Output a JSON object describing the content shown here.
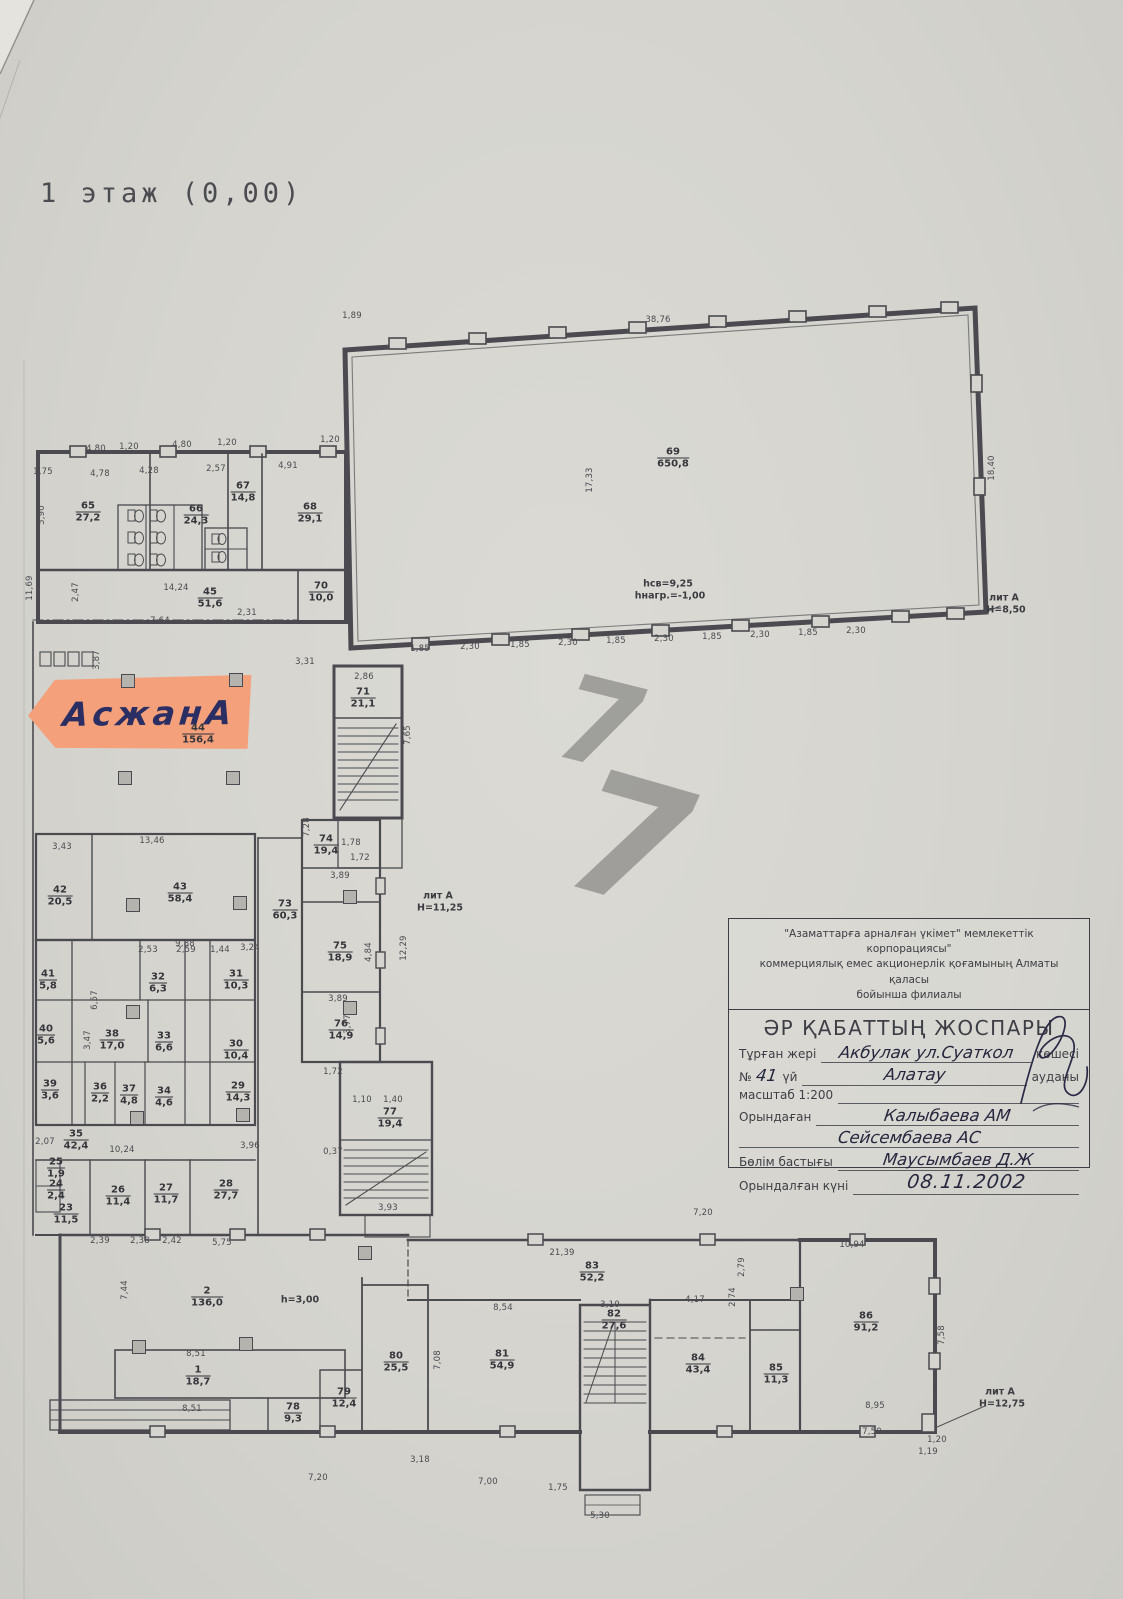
{
  "page": {
    "floor_title": "1 этаж (0,00)"
  },
  "sticker": {
    "text": "АсжанА"
  },
  "watermark": [
    {
      "t": "7",
      "x": 600,
      "y": 724,
      "s": 118,
      "r": 14
    },
    {
      "t": "7",
      "x": 630,
      "y": 842,
      "s": 168,
      "r": 16
    }
  ],
  "title_block": {
    "org_line1": "\"Азаматтарға арналған үкімет\" мемлекеттік корпорациясы\"",
    "org_line2": "коммерциялық емес акционерлік қоғамының Алматы қаласы",
    "org_line3": "бойынша филиалы",
    "heading": "ӘР ҚАБАТТЫҢ ЖОСПАРЫ",
    "label_location": "Тұрған жері",
    "location_value": "Акбулак ул.Суаткол",
    "label_street_suffix": "көшесі",
    "label_no": "№",
    "house_no": "41",
    "label_house": "үй",
    "district_value": "Алатау",
    "label_district": "ауданы",
    "scale": "масштаб 1:200",
    "label_executor": "Орындаған",
    "executor1": "Калыбаева АМ",
    "executor2": "Сейсембаева АС",
    "label_head": "Бөлім бастығы",
    "head_name": "Маусымбаев Д.Ж",
    "label_date": "Орындалған күні",
    "date": "08.11.2002"
  },
  "plan": {
    "rooms": [
      {
        "n": "65",
        "a": "27,2",
        "x": 88,
        "y": 512
      },
      {
        "n": "66",
        "a": "24,3",
        "x": 196,
        "y": 515
      },
      {
        "n": "67",
        "a": "14,8",
        "x": 243,
        "y": 492
      },
      {
        "n": "68",
        "a": "29,1",
        "x": 310,
        "y": 513
      },
      {
        "n": "45",
        "a": "51,6",
        "x": 210,
        "y": 598
      },
      {
        "n": "70",
        "a": "10,0",
        "x": 321,
        "y": 592
      },
      {
        "n": "71",
        "a": "21,1",
        "x": 363,
        "y": 698
      },
      {
        "n": "44",
        "a": "156,4",
        "x": 198,
        "y": 734
      },
      {
        "n": "74",
        "a": "19,4",
        "x": 326,
        "y": 845
      },
      {
        "n": "73",
        "a": "60,3",
        "x": 285,
        "y": 910
      },
      {
        "n": "75",
        "a": "18,9",
        "x": 340,
        "y": 952
      },
      {
        "n": "76",
        "a": "14,9",
        "x": 341,
        "y": 1030
      },
      {
        "n": "77",
        "a": "19,4",
        "x": 390,
        "y": 1118
      },
      {
        "n": "69",
        "a": "650,8",
        "x": 673,
        "y": 458
      },
      {
        "n": "42",
        "a": "20,5",
        "x": 60,
        "y": 896
      },
      {
        "n": "43",
        "a": "58,4",
        "x": 180,
        "y": 893
      },
      {
        "n": "41",
        "a": "5,8",
        "x": 48,
        "y": 980
      },
      {
        "n": "32",
        "a": "6,3",
        "x": 158,
        "y": 983
      },
      {
        "n": "31",
        "a": "10,3",
        "x": 236,
        "y": 980
      },
      {
        "n": "40",
        "a": "5,6",
        "x": 46,
        "y": 1035
      },
      {
        "n": "38",
        "a": "17,0",
        "x": 112,
        "y": 1040
      },
      {
        "n": "33",
        "a": "6,6",
        "x": 164,
        "y": 1042
      },
      {
        "n": "30",
        "a": "10,4",
        "x": 236,
        "y": 1050
      },
      {
        "n": "39",
        "a": "3,6",
        "x": 50,
        "y": 1090
      },
      {
        "n": "36",
        "a": "2,2",
        "x": 100,
        "y": 1093
      },
      {
        "n": "37",
        "a": "4,8",
        "x": 129,
        "y": 1095
      },
      {
        "n": "34",
        "a": "4,6",
        "x": 164,
        "y": 1097
      },
      {
        "n": "29",
        "a": "14,3",
        "x": 238,
        "y": 1092
      },
      {
        "n": "35",
        "a": "42,4",
        "x": 76,
        "y": 1140
      },
      {
        "n": "25",
        "a": "1,9",
        "x": 56,
        "y": 1168
      },
      {
        "n": "24",
        "a": "2,4",
        "x": 56,
        "y": 1190
      },
      {
        "n": "23",
        "a": "11,5",
        "x": 66,
        "y": 1214
      },
      {
        "n": "26",
        "a": "11,4",
        "x": 118,
        "y": 1196
      },
      {
        "n": "27",
        "a": "11,7",
        "x": 166,
        "y": 1194
      },
      {
        "n": "28",
        "a": "27,7",
        "x": 226,
        "y": 1190
      },
      {
        "n": "2",
        "a": "136,0",
        "x": 207,
        "y": 1297
      },
      {
        "n": "1",
        "a": "18,7",
        "x": 198,
        "y": 1376
      },
      {
        "n": "78",
        "a": "9,3",
        "x": 293,
        "y": 1413
      },
      {
        "n": "79",
        "a": "12,4",
        "x": 344,
        "y": 1398
      },
      {
        "n": "80",
        "a": "25,5",
        "x": 396,
        "y": 1362
      },
      {
        "n": "81",
        "a": "54,9",
        "x": 502,
        "y": 1360
      },
      {
        "n": "82",
        "a": "27,6",
        "x": 614,
        "y": 1320
      },
      {
        "n": "83",
        "a": "52,2",
        "x": 592,
        "y": 1272
      },
      {
        "n": "84",
        "a": "43,4",
        "x": 698,
        "y": 1364
      },
      {
        "n": "85",
        "a": "11,3",
        "x": 776,
        "y": 1374
      },
      {
        "n": "86",
        "a": "91,2",
        "x": 866,
        "y": 1322
      }
    ],
    "annotations": [
      {
        "t": "лит А",
        "x": 1004,
        "y": 598
      },
      {
        "t": "Н=8,50",
        "x": 1006,
        "y": 610
      },
      {
        "t": "лит А",
        "x": 438,
        "y": 896
      },
      {
        "t": "Н=11,25",
        "x": 440,
        "y": 908
      },
      {
        "t": "hсв=9,25",
        "x": 668,
        "y": 584
      },
      {
        "t": "hнагр.=-1,00",
        "x": 670,
        "y": 596
      },
      {
        "t": "h=3,00",
        "x": 300,
        "y": 1300
      },
      {
        "t": "лит А",
        "x": 1000,
        "y": 1392
      },
      {
        "t": "Н=12,75",
        "x": 1002,
        "y": 1404
      }
    ],
    "dims": [
      {
        "t": "4,80",
        "x": 96,
        "y": 449
      },
      {
        "t": "1,20",
        "x": 129,
        "y": 447
      },
      {
        "t": "4,80",
        "x": 182,
        "y": 445
      },
      {
        "t": "1,20",
        "x": 227,
        "y": 443
      },
      {
        "t": "1,20",
        "x": 330,
        "y": 440
      },
      {
        "t": "1,75",
        "x": 43,
        "y": 472
      },
      {
        "t": "4,78",
        "x": 100,
        "y": 474
      },
      {
        "t": "4,28",
        "x": 149,
        "y": 471
      },
      {
        "t": "2,57",
        "x": 216,
        "y": 469
      },
      {
        "t": "4,91",
        "x": 288,
        "y": 466
      },
      {
        "t": "5,90",
        "x": 42,
        "y": 515,
        "v": 1
      },
      {
        "t": "11,69",
        "x": 30,
        "y": 588,
        "v": 1
      },
      {
        "t": "2,47",
        "x": 76,
        "y": 592,
        "v": 1
      },
      {
        "t": "14,24",
        "x": 176,
        "y": 588
      },
      {
        "t": "7,64",
        "x": 160,
        "y": 621
      },
      {
        "t": "2,31",
        "x": 247,
        "y": 613
      },
      {
        "t": "3,87",
        "x": 97,
        "y": 660,
        "v": 1
      },
      {
        "t": "3,31",
        "x": 305,
        "y": 662
      },
      {
        "t": "2,86",
        "x": 364,
        "y": 677
      },
      {
        "t": "7,65",
        "x": 408,
        "y": 735,
        "v": 1
      },
      {
        "t": "7,28",
        "x": 307,
        "y": 827,
        "v": 1
      },
      {
        "t": "1,78",
        "x": 351,
        "y": 843
      },
      {
        "t": "1,72",
        "x": 360,
        "y": 858
      },
      {
        "t": "3,89",
        "x": 340,
        "y": 876
      },
      {
        "t": "3,89",
        "x": 338,
        "y": 999
      },
      {
        "t": "4,84",
        "x": 369,
        "y": 952,
        "v": 1
      },
      {
        "t": "12,29",
        "x": 404,
        "y": 948,
        "v": 1
      },
      {
        "t": "3,77",
        "x": 348,
        "y": 1024,
        "v": 1
      },
      {
        "t": "1,72",
        "x": 333,
        "y": 1072
      },
      {
        "t": "1,10",
        "x": 362,
        "y": 1100
      },
      {
        "t": "1,40",
        "x": 393,
        "y": 1100
      },
      {
        "t": "3,93",
        "x": 388,
        "y": 1208
      },
      {
        "t": "0,37",
        "x": 333,
        "y": 1152
      },
      {
        "t": "1,89",
        "x": 352,
        "y": 316
      },
      {
        "t": "38,76",
        "x": 658,
        "y": 320
      },
      {
        "t": "17,33",
        "x": 590,
        "y": 480,
        "v": 1
      },
      {
        "t": "18,40",
        "x": 992,
        "y": 468,
        "v": 1
      },
      {
        "t": "1,85",
        "x": 420,
        "y": 649
      },
      {
        "t": "2,30",
        "x": 470,
        "y": 647
      },
      {
        "t": "1,85",
        "x": 520,
        "y": 645
      },
      {
        "t": "2,30",
        "x": 568,
        "y": 643
      },
      {
        "t": "1,85",
        "x": 616,
        "y": 641
      },
      {
        "t": "2,30",
        "x": 664,
        "y": 639
      },
      {
        "t": "1,85",
        "x": 712,
        "y": 637
      },
      {
        "t": "2,30",
        "x": 760,
        "y": 635
      },
      {
        "t": "1,85",
        "x": 808,
        "y": 633
      },
      {
        "t": "2,30",
        "x": 856,
        "y": 631
      },
      {
        "t": "13,46",
        "x": 152,
        "y": 841
      },
      {
        "t": "3,43",
        "x": 62,
        "y": 847
      },
      {
        "t": "9,88",
        "x": 185,
        "y": 944
      },
      {
        "t": "2,53",
        "x": 148,
        "y": 950
      },
      {
        "t": "2,59",
        "x": 186,
        "y": 950
      },
      {
        "t": "1,44",
        "x": 220,
        "y": 950
      },
      {
        "t": "3,24",
        "x": 250,
        "y": 948
      },
      {
        "t": "3,47",
        "x": 88,
        "y": 1040,
        "v": 1
      },
      {
        "t": "6,57",
        "x": 95,
        "y": 1000,
        "v": 1
      },
      {
        "t": "10,24",
        "x": 122,
        "y": 1150
      },
      {
        "t": "3,96",
        "x": 250,
        "y": 1146
      },
      {
        "t": "2,07",
        "x": 45,
        "y": 1142
      },
      {
        "t": "2,39",
        "x": 100,
        "y": 1241
      },
      {
        "t": "2,38",
        "x": 140,
        "y": 1241
      },
      {
        "t": "2,42",
        "x": 172,
        "y": 1241
      },
      {
        "t": "5,75",
        "x": 222,
        "y": 1243
      },
      {
        "t": "7,44",
        "x": 125,
        "y": 1290,
        "v": 1
      },
      {
        "t": "8,51",
        "x": 196,
        "y": 1354
      },
      {
        "t": "8,51",
        "x": 192,
        "y": 1409
      },
      {
        "t": "21,39",
        "x": 562,
        "y": 1253
      },
      {
        "t": "8,54",
        "x": 503,
        "y": 1308
      },
      {
        "t": "3,10",
        "x": 610,
        "y": 1305
      },
      {
        "t": "4,17",
        "x": 695,
        "y": 1300
      },
      {
        "t": "2,74",
        "x": 733,
        "y": 1297,
        "v": 1
      },
      {
        "t": "7,08",
        "x": 438,
        "y": 1360,
        "v": 1
      },
      {
        "t": "2,79",
        "x": 742,
        "y": 1267,
        "v": 1
      },
      {
        "t": "7,20",
        "x": 703,
        "y": 1213
      },
      {
        "t": "10,94",
        "x": 852,
        "y": 1245
      },
      {
        "t": "7,58",
        "x": 942,
        "y": 1335,
        "v": 1
      },
      {
        "t": "8,95",
        "x": 875,
        "y": 1406
      },
      {
        "t": "7,50",
        "x": 872,
        "y": 1432
      },
      {
        "t": "1,20",
        "x": 937,
        "y": 1440
      },
      {
        "t": "3,18",
        "x": 420,
        "y": 1460
      },
      {
        "t": "7,20",
        "x": 318,
        "y": 1478
      },
      {
        "t": "7,00",
        "x": 488,
        "y": 1482
      },
      {
        "t": "1,75",
        "x": 558,
        "y": 1488
      },
      {
        "t": "5,30",
        "x": 600,
        "y": 1516
      },
      {
        "t": "1,19",
        "x": 928,
        "y": 1452
      }
    ],
    "columns": [
      [
        128,
        681
      ],
      [
        236,
        680
      ],
      [
        125,
        778
      ],
      [
        233,
        778
      ],
      [
        133,
        905
      ],
      [
        240,
        903
      ],
      [
        133,
        1012
      ],
      [
        137,
        1118
      ],
      [
        243,
        1115
      ],
      [
        139,
        1347
      ],
      [
        246,
        1344
      ],
      [
        365,
        1253
      ],
      [
        797,
        1294
      ],
      [
        350,
        897
      ],
      [
        350,
        1008
      ]
    ]
  }
}
